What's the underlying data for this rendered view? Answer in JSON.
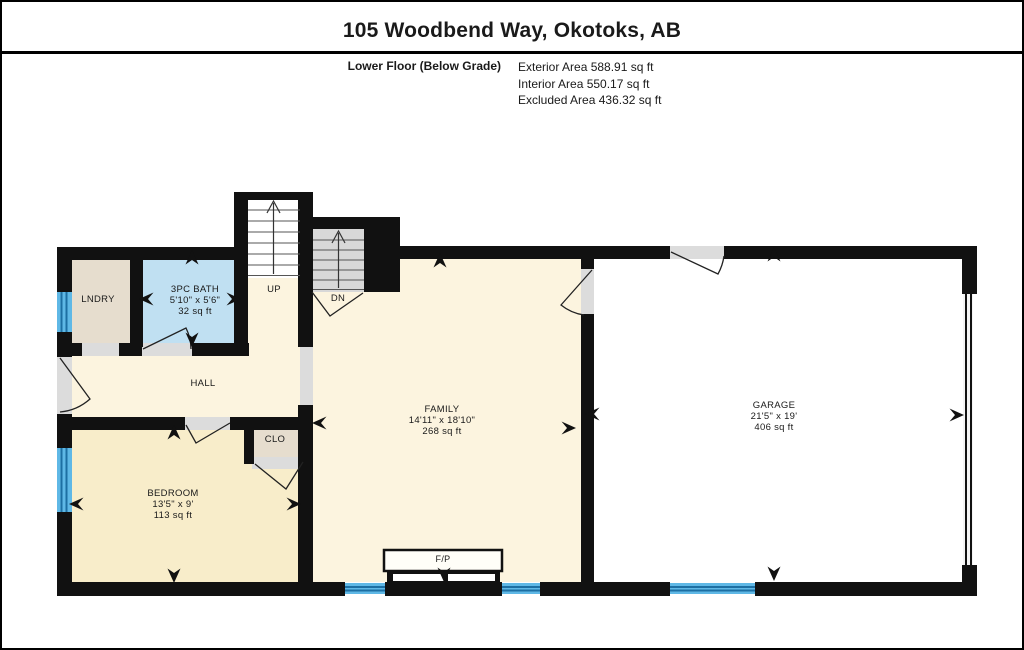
{
  "header": {
    "title": "105 Woodbend Way, Okotoks, AB",
    "floor_label": "Lower Floor (Below Grade)",
    "area_lines": [
      "Exterior Area 588.91 sq ft",
      "Interior Area 550.17 sq ft",
      "Excluded Area 436.32 sq ft"
    ]
  },
  "rooms": {
    "lndry": {
      "name": "LNDRY"
    },
    "bath": {
      "name": "3PC BATH",
      "dims": "5'10\" x 5'6\"",
      "area": "32 sq ft"
    },
    "hall": {
      "name": "HALL"
    },
    "clo": {
      "name": "CLO"
    },
    "bedroom": {
      "name": "BEDROOM",
      "dims": "13'5\" x 9'",
      "area": "113 sq ft"
    },
    "family": {
      "name": "FAMILY",
      "dims": "14'11\" x 18'10\"",
      "area": "268 sq ft"
    },
    "garage": {
      "name": "GARAGE",
      "dims": "21'5\" x 19'",
      "area": "406 sq ft"
    }
  },
  "stairs": {
    "up_label": "UP",
    "down_label": "DN"
  },
  "fireplace_label": "F/P",
  "colors": {
    "ink": "#1a1a1a",
    "wall": "#111111",
    "cream": "#fcf4df",
    "bedroom": "#f8edca",
    "tan": "#e6ddce",
    "bath": "#c0e0f2",
    "garage": "#ffffff",
    "stair": "#d8d8d8",
    "opening": "#dcdcdc",
    "winlight": "#5fb8e6",
    "windark": "#1d6fa3"
  }
}
